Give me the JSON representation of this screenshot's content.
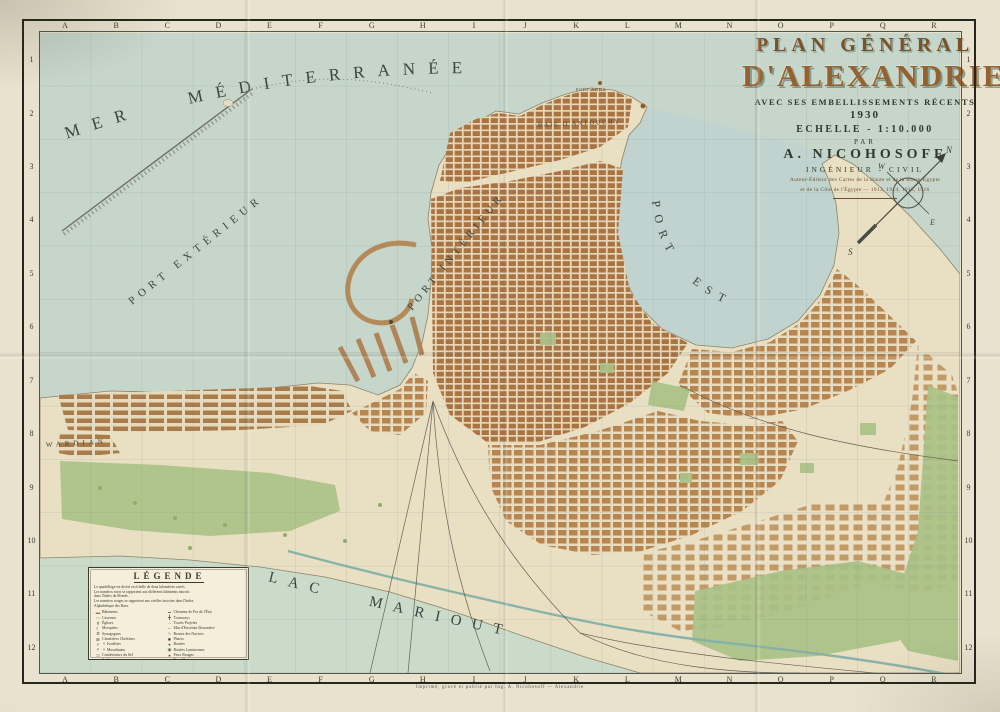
{
  "title_block": {
    "line1": "PLAN GÉNÉRAL",
    "line2": "D'ALEXANDRIE",
    "subtitle": "AVEC SES EMBELLISSEMENTS RÉCENTS",
    "year": "1930",
    "scale": "ECHELLE - 1:10.000",
    "par": "PAR",
    "author": "A. NICOHOSOFF",
    "author_role": "INGÉNIEUR - CIVIL",
    "note1": "Auteur-Éditeur des Cartes de la Haute et de la Basse-Égypte",
    "note2": "et de la Côte de l'Égypte — 1913, 1914, 1915, 1916"
  },
  "grid": {
    "columns": [
      "A",
      "B",
      "C",
      "D",
      "E",
      "F",
      "G",
      "H",
      "I",
      "J",
      "K",
      "L",
      "M",
      "N",
      "O",
      "P",
      "Q",
      "R"
    ],
    "rows": [
      "1",
      "2",
      "3",
      "4",
      "5",
      "6",
      "7",
      "8",
      "9",
      "10",
      "11",
      "12"
    ]
  },
  "sea_labels": {
    "mer": "MER MÉDITERRANÉE",
    "port_exterieur": "PORT EXTÉRIEUR",
    "port_interieur": "PORT INTÉRIEUR",
    "port_est": "PORT EST",
    "baie": "BAIE D'ANFOUCHY",
    "lac": "LAC MARIOUT",
    "wardian": "WARDIAN",
    "fort": "FORT ADDA"
  },
  "compass": {
    "n": "N",
    "e": "E",
    "s": "S",
    "w": "W"
  },
  "legend": {
    "title": "LÉGENDE",
    "intro": [
      "Le quadrillage est divisé en échelle de deux kilomètres carrés.",
      "Les numéros noirs se rapportent aux différents bâtiments inscrits",
      "dans l'Index du Monde.",
      "Les numéros rouges se rapportent aux vieilles inscrites dans l'Index",
      "Alphabétique des Rues."
    ],
    "left_items": [
      {
        "sym": "▬",
        "color": "#a56e3f",
        "label": "Bâtiments"
      },
      {
        "sym": "▭",
        "color": "#c79a62",
        "label": "Casernes"
      },
      {
        "sym": "✝",
        "color": "#3a3a32",
        "label": "Églises"
      },
      {
        "sym": "☾",
        "color": "#3a3a32",
        "label": "Mosquées"
      },
      {
        "sym": "✡",
        "color": "#3a3a32",
        "label": "Synagogues"
      },
      {
        "sym": "⊞",
        "color": "#55554a",
        "label": "Cimetières Chrétiens"
      },
      {
        "sym": "〃",
        "color": "#55554a",
        "label": "      〃      Israélites"
      },
      {
        "sym": "〃",
        "color": "#55554a",
        "label": "      〃      Musulmans"
      },
      {
        "sym": "▤",
        "color": "#b3a87e",
        "label": "Condenseurs du Sel"
      },
      {
        "sym": "▩",
        "color": "#7f9a55",
        "label": "Jardins"
      },
      {
        "sym": "▨",
        "color": "#9a9078",
        "label": "Chantiers"
      },
      {
        "sym": "✿",
        "color": "#7f9a55",
        "label": "Arbres"
      },
      {
        "sym": "▢",
        "color": "#b3a87e",
        "label": "Terrains Vagues"
      }
    ],
    "right_items": [
      {
        "sym": "━",
        "color": "#44443c",
        "label": "Chemins de Fer de l'État"
      },
      {
        "sym": "╋",
        "color": "#44443c",
        "label": "Tramways"
      },
      {
        "sym": "┄",
        "color": "#8a8578",
        "label": "Tracés Projetés"
      },
      {
        "sym": "─",
        "color": "#7a5a3a",
        "label": "Mur d'Enceinte Douanière"
      },
      {
        "sym": "∿",
        "color": "#6e8f8a",
        "label": "Routes des Navires"
      },
      {
        "sym": "✹",
        "color": "#44443c",
        "label": "Phares"
      },
      {
        "sym": "●",
        "color": "#55554a",
        "label": "Bouées"
      },
      {
        "sym": "◉",
        "color": "#55554a",
        "label": "Bouées Lumineuses"
      },
      {
        "sym": "●",
        "color": "#b23a2e",
        "label": "Feux Rouges"
      },
      {
        "sym": "●",
        "color": "#4e7d46",
        "label": "Feux Verts"
      },
      {
        "sym": "⚓",
        "color": "#44443c",
        "label": "Mouillages"
      },
      {
        "sym": "№",
        "color": "#44443c",
        "label": "Numérotage des Quais de N°1 à 84"
      },
      {
        "sym": "№",
        "color": "#8f2f28",
        "label": "Numérotage des Portes de Douane"
      }
    ]
  },
  "imprint": "Imprimé, gravé et publié par Ing. A. Nicohosoff — Alexandrie",
  "colors": {
    "paper": "#e9e2cf",
    "sea": "#c6d6ca",
    "bay": "#bdd2d2",
    "land": "#e9dfc3",
    "city_blocks": "#aa7342",
    "parks": "#a9c287",
    "canal": "#84b0a8",
    "frame": "#26261e",
    "title_brown": "#95622f",
    "title_shadow_teal": "#4f7a72"
  }
}
